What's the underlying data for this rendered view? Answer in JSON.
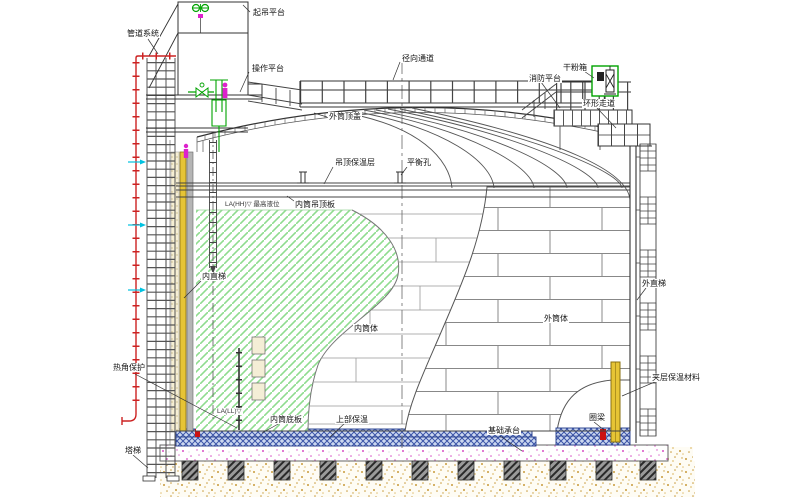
{
  "labels": {
    "piping_system": "管道系统",
    "lifting_platform": "起吊平台",
    "operation_platform": "操作平台",
    "outer_shell_roof": "外筒顶盖",
    "radial_walkway": "径向通道",
    "fire_platform": "消防平台",
    "dry_powder_box": "干粉箱",
    "ring_walkway": "环形走道",
    "ceiling_insulation": "吊顶保温层",
    "balance_hole": "平衡孔",
    "inner_ceiling_plate": "内筒吊顶板",
    "high_liquid_level": "LA(HH)▽ 最高液位",
    "inner_ladder": "内直梯",
    "inner_shell": "内筒体",
    "outer_shell": "外筒体",
    "outer_ladder": "外直梯",
    "thermal_corner_protection": "热角保护",
    "interlayer_insulation": "夹层保温材料",
    "low_liquid_level": "LA(LL)▽",
    "inner_bottom_plate": "内筒底板",
    "upper_insulation": "上部保温",
    "foundation_pile_cap": "基础承台",
    "ring_beam": "圈梁",
    "tower_ladder": "塔梯"
  },
  "colors": {
    "pipe_red": "#cc2222",
    "interior_hatch_green": "#8fdc8f",
    "insulation_yellow": "#e6c435",
    "flow_arrow_cyan": "#00c2e0",
    "equipment_green": "#00a300",
    "person_magenta": "#dd22cc",
    "bottom_insulation_blue": "#3c55a8",
    "concrete_speckle_pink": "#d84fc4",
    "ground_sand_tan": "#c89b3c"
  }
}
